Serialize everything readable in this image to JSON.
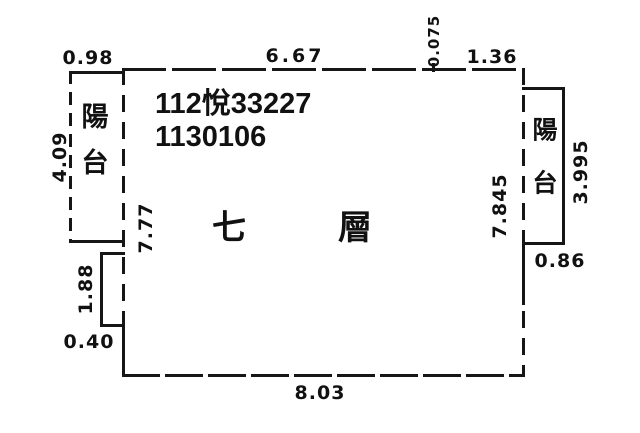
{
  "plan": {
    "stamp": {
      "line1": "112悅33227",
      "line2": "1130106"
    },
    "floor_label": "七層",
    "balcony_left": {
      "label": "陽台"
    },
    "balcony_right": {
      "label": "陽台"
    },
    "dimensions": {
      "balcony_left_width": "0.98",
      "top_width": "6.67",
      "top_offset": "0.075",
      "top_right_width": "1.36",
      "balcony_left_height": "4.09",
      "interior_left_height": "7.77",
      "notch_height": "1.88",
      "notch_width": "0.40",
      "bottom_width": "8.03",
      "interior_right_height": "7.845",
      "balcony_right_height": "3.995",
      "balcony_right_width": "0.86"
    }
  }
}
